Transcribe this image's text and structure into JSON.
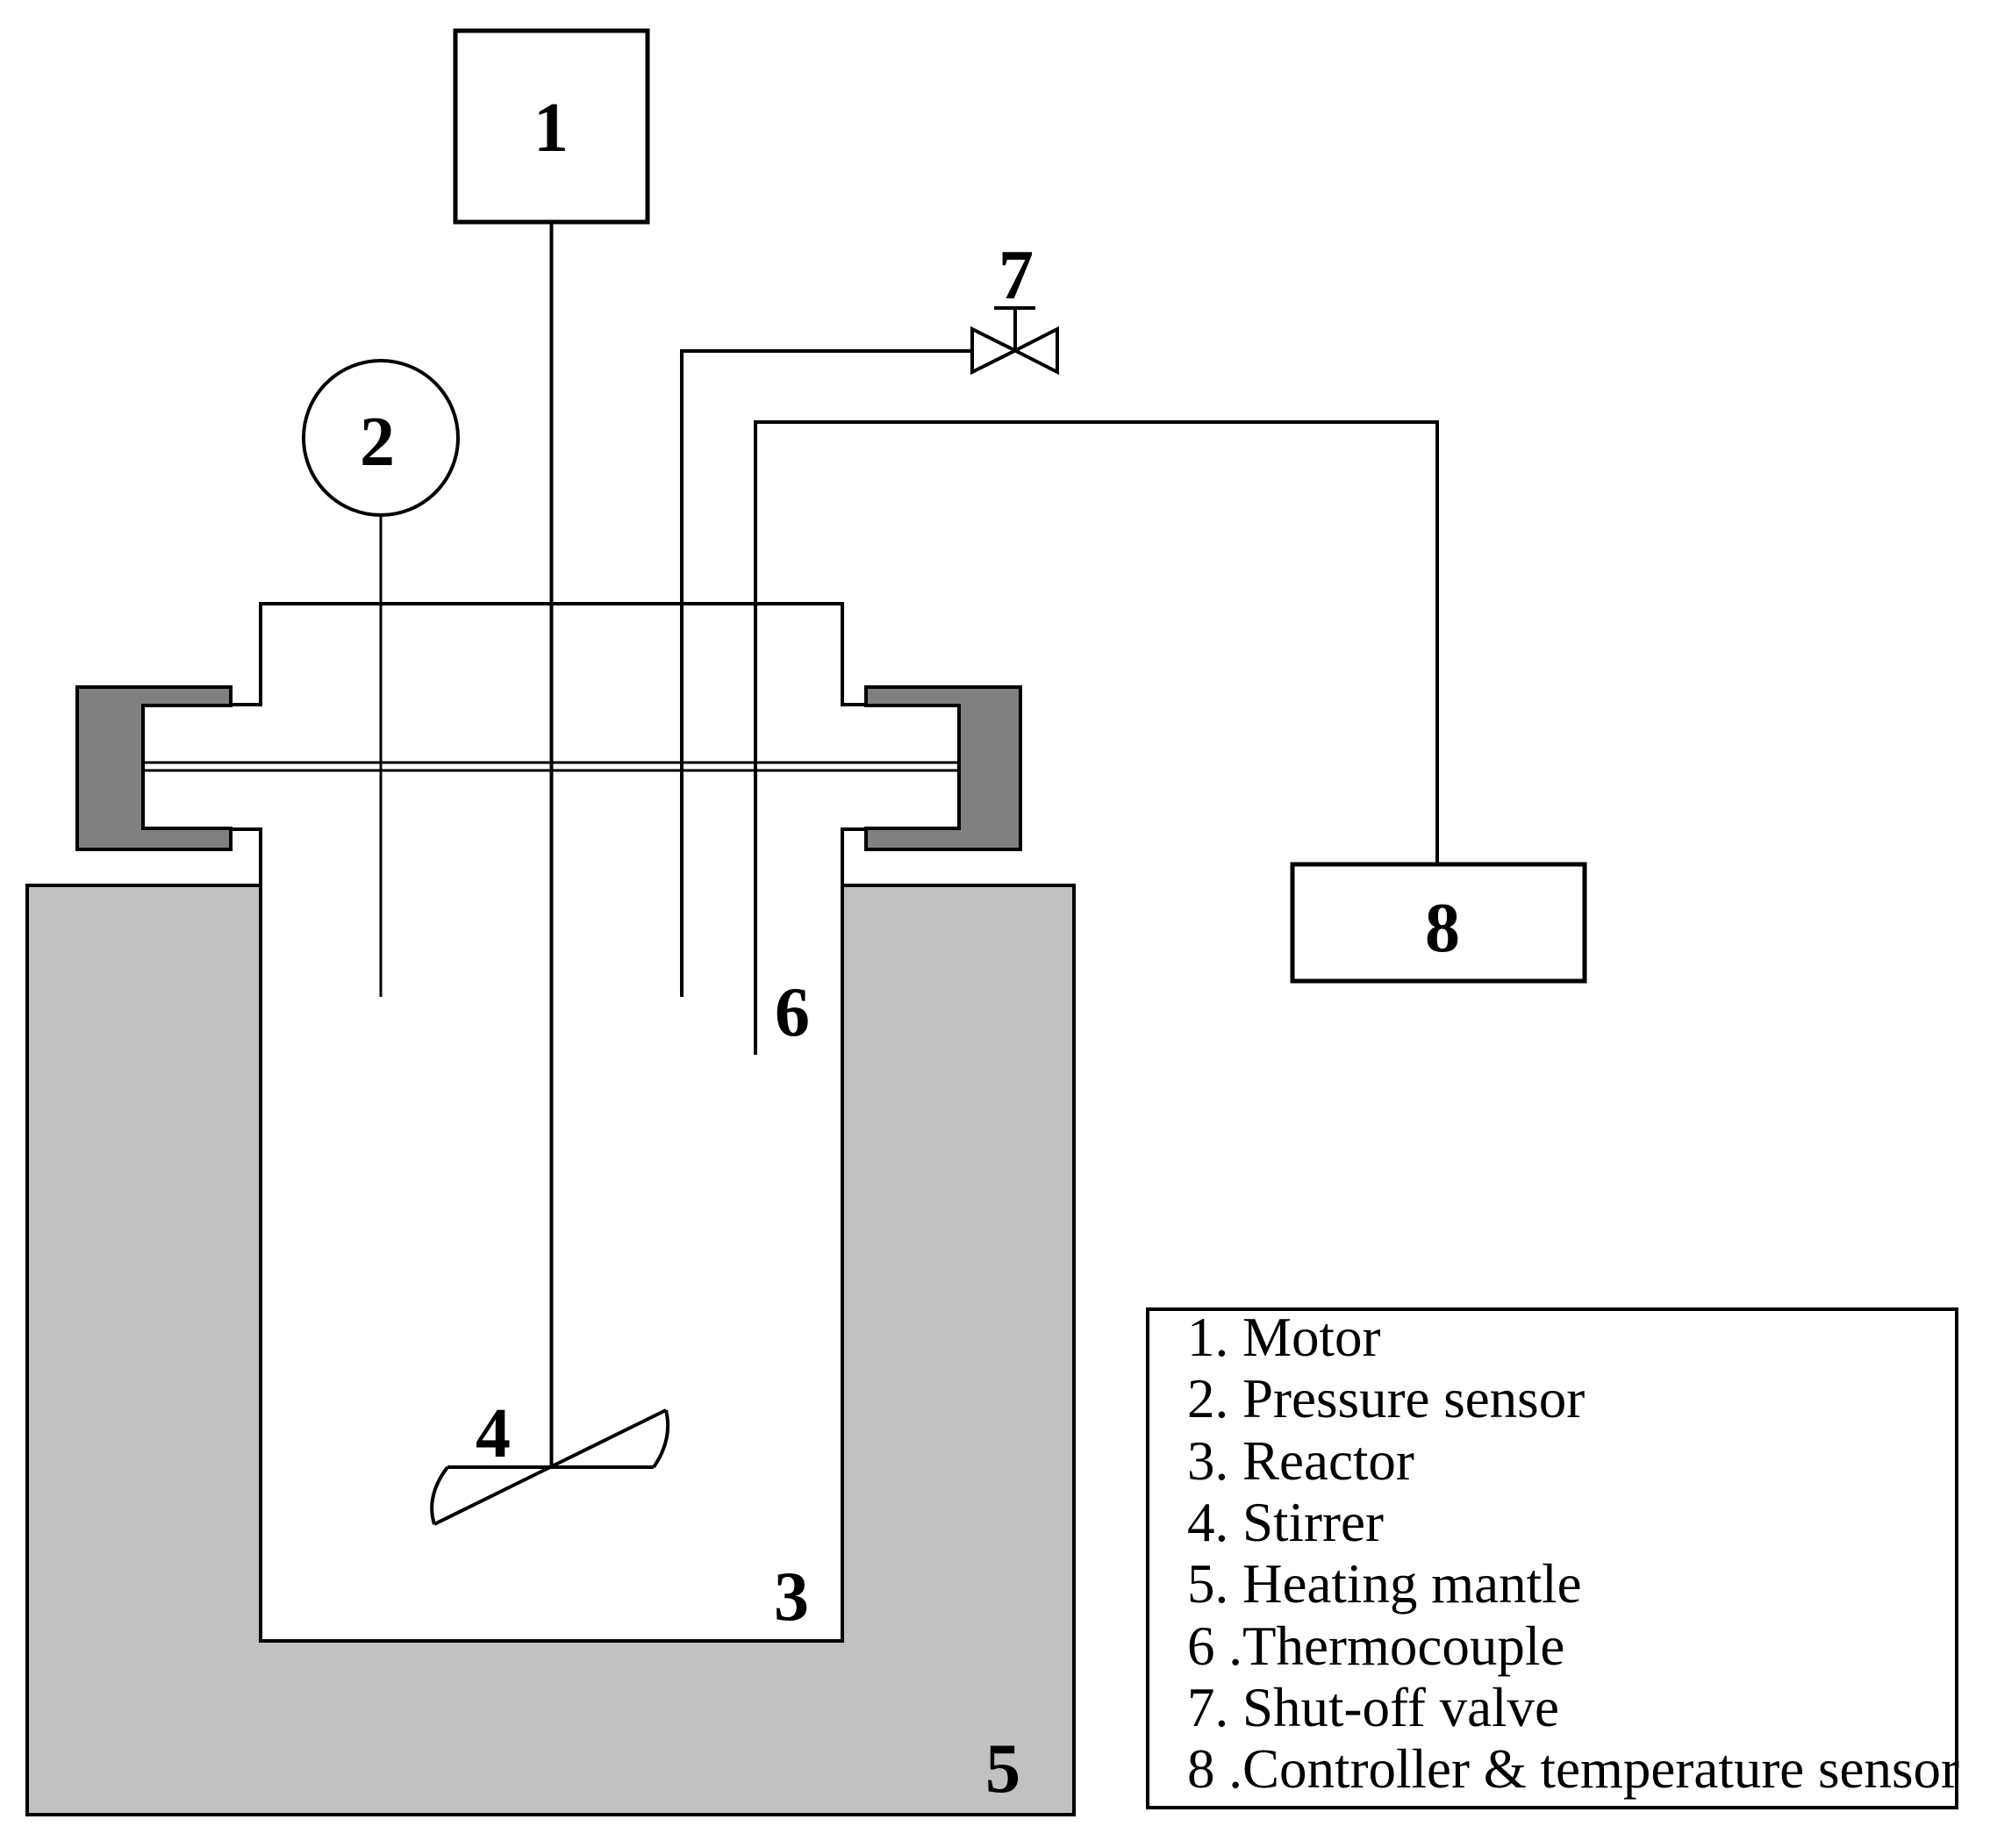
{
  "figure": {
    "kind": "laboratory-reactor-schematic",
    "labels": {
      "motor": "1",
      "pressure_sensor": "2",
      "reactor": "3",
      "stirrer": "4",
      "heating_mantle": "5",
      "thermocouple": "6",
      "shut_off_valve": "7",
      "controller": "8"
    },
    "legend": {
      "items": [
        "1. Motor",
        "2. Pressure sensor",
        "3. Reactor",
        "4. Stirrer",
        "5. Heating mantle",
        "6 .Thermocouple",
        "7. Shut-off valve",
        "8 .Controller & temperature sensor"
      ]
    },
    "colors": {
      "heating_mantle": "#c1c1c1",
      "clamp": "#808080",
      "line": "#000000",
      "background": "#ffffff"
    }
  }
}
